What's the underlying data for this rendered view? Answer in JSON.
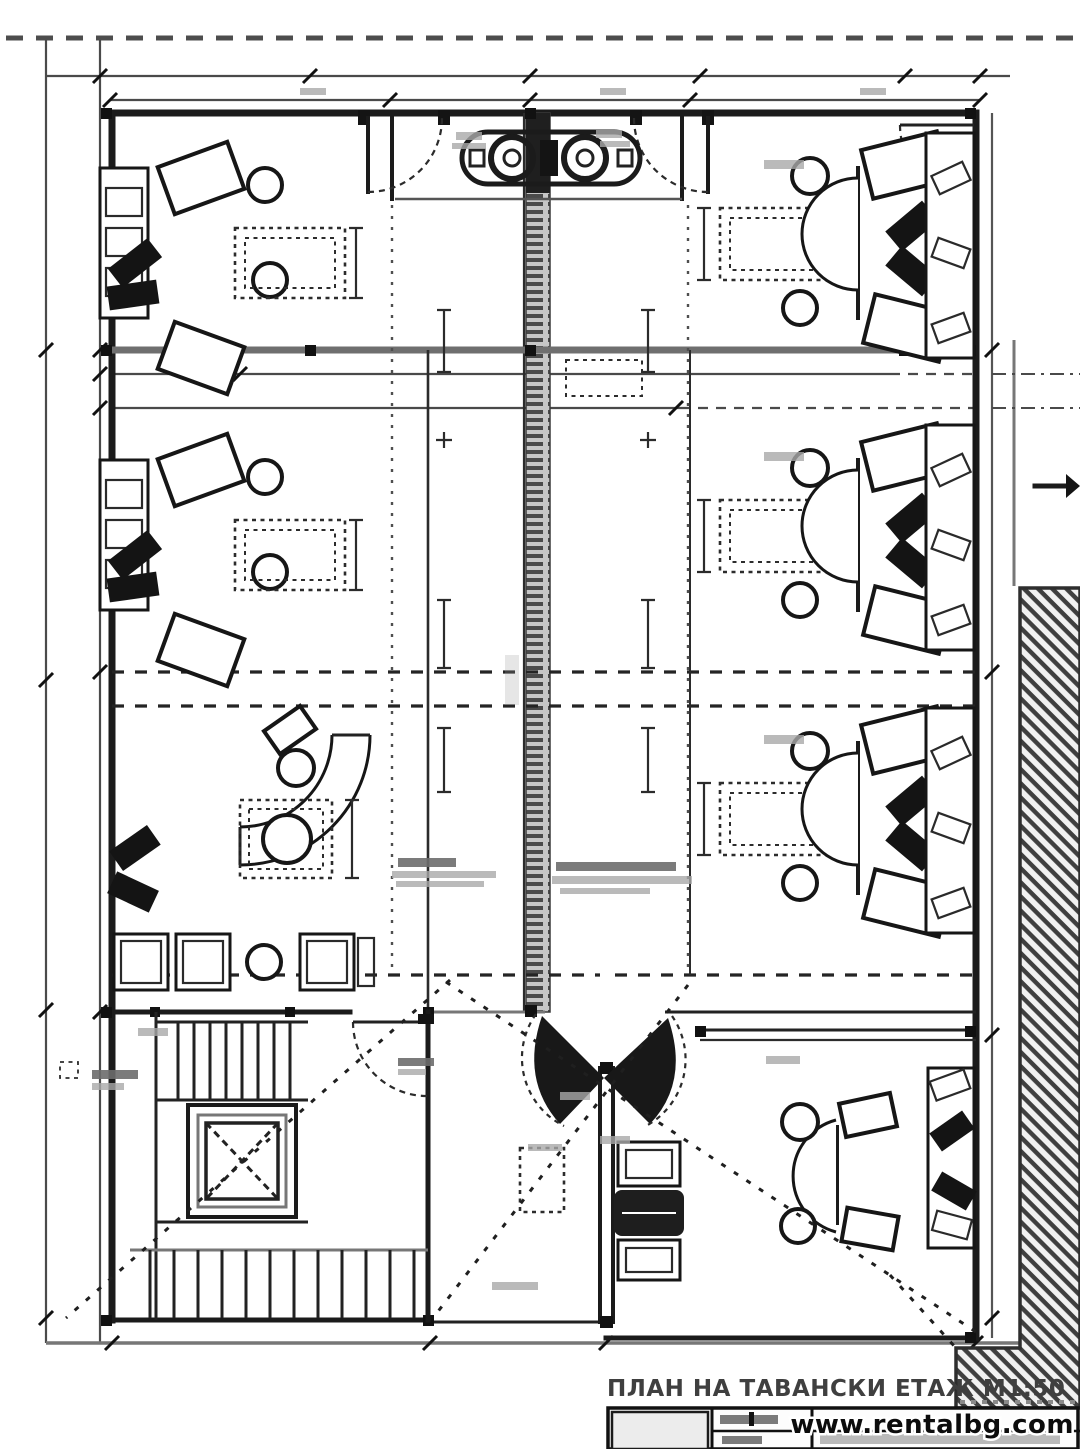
{
  "document": {
    "title": "ПЛАН НА ТАВАНСКИ ЕТАЖ М1:50",
    "floor_label": "ТАВАНСКИ ЕТАЖ",
    "scale": "М1:50",
    "watermark": "www.rentalbg.com"
  },
  "palette": {
    "paper": "#ffffff",
    "ink": "#1b1b1b",
    "wall_gray": "#6f6f6f",
    "dim_line": "#4a4a4a",
    "smudge": "#a9a9a9",
    "hatch_ink": "#3f3f3f",
    "title_text": "#3f3f3f",
    "watermark_fill": "#0c0c0c",
    "watermark_halo": "#ffffff",
    "titleblock_fill": "#ececec"
  }
}
